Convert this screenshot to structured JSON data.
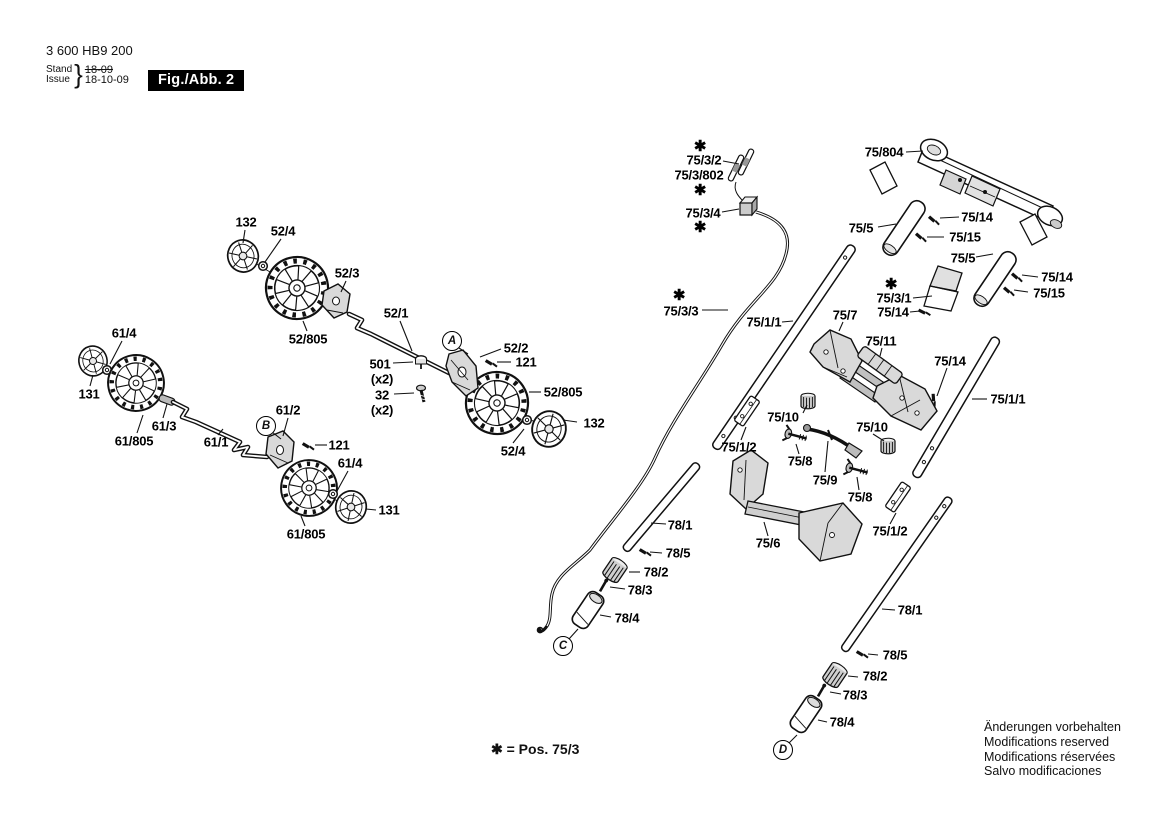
{
  "header": {
    "part_number": "3 600 HB9 200",
    "stand_label": "Stand",
    "issue_label": "Issue",
    "brace": "}",
    "stand_value": "18-09",
    "issue_value": "18-10-09",
    "figure_label": "Fig./Abb. 2"
  },
  "footnote": {
    "text": "✱ = Pos. 75/3"
  },
  "disclaimer": {
    "lines": [
      "Änderungen vorbehalten",
      "Modifications reserved",
      "Modifications réservées",
      "Salvo modificaciones"
    ]
  },
  "diagram": {
    "callouts": [
      {
        "letter": "A",
        "x": 452,
        "y": 341
      },
      {
        "letter": "B",
        "x": 266,
        "y": 426
      },
      {
        "letter": "C",
        "x": 563,
        "y": 646
      },
      {
        "letter": "D",
        "x": 783,
        "y": 750
      }
    ],
    "labels": [
      {
        "text": "132",
        "x": 246,
        "y": 222
      },
      {
        "text": "52/4",
        "x": 283,
        "y": 231
      },
      {
        "text": "52/3",
        "x": 347,
        "y": 273
      },
      {
        "text": "52/805",
        "x": 308,
        "y": 339
      },
      {
        "text": "52/1",
        "x": 396,
        "y": 313
      },
      {
        "text": "61/4",
        "x": 124,
        "y": 333
      },
      {
        "text": "131",
        "x": 89,
        "y": 394
      },
      {
        "text": "61/805",
        "x": 134,
        "y": 441
      },
      {
        "text": "61/3",
        "x": 164,
        "y": 426
      },
      {
        "text": "61/1",
        "x": 216,
        "y": 442
      },
      {
        "text": "61/2",
        "x": 288,
        "y": 410
      },
      {
        "text": "501",
        "x": 380,
        "y": 364
      },
      {
        "text": "(x2)",
        "x": 382,
        "y": 379
      },
      {
        "text": "32",
        "x": 382,
        "y": 395
      },
      {
        "text": "(x2)",
        "x": 382,
        "y": 410
      },
      {
        "text": "52/2",
        "x": 516,
        "y": 348
      },
      {
        "text": "121",
        "x": 526,
        "y": 362
      },
      {
        "text": "52/805",
        "x": 563,
        "y": 392
      },
      {
        "text": "132",
        "x": 594,
        "y": 423
      },
      {
        "text": "52/4",
        "x": 513,
        "y": 451
      },
      {
        "text": "121",
        "x": 339,
        "y": 445
      },
      {
        "text": "61/4",
        "x": 350,
        "y": 463
      },
      {
        "text": "131",
        "x": 389,
        "y": 510
      },
      {
        "text": "61/805",
        "x": 306,
        "y": 534
      },
      {
        "text": "✱",
        "x": 700,
        "y": 146,
        "star": true
      },
      {
        "text": "75/3/2",
        "x": 704,
        "y": 160
      },
      {
        "text": "75/3/802",
        "x": 699,
        "y": 175
      },
      {
        "text": "✱",
        "x": 700,
        "y": 190,
        "star": true
      },
      {
        "text": "75/3/4",
        "x": 703,
        "y": 213
      },
      {
        "text": "✱",
        "x": 700,
        "y": 227,
        "star": true
      },
      {
        "text": "75/804",
        "x": 884,
        "y": 152
      },
      {
        "text": "75/5",
        "x": 861,
        "y": 228
      },
      {
        "text": "75/14",
        "x": 977,
        "y": 217
      },
      {
        "text": "75/15",
        "x": 965,
        "y": 237
      },
      {
        "text": "75/5",
        "x": 963,
        "y": 258
      },
      {
        "text": "75/14",
        "x": 1057,
        "y": 277
      },
      {
        "text": "75/15",
        "x": 1049,
        "y": 293
      },
      {
        "text": "✱",
        "x": 891,
        "y": 284,
        "star": true
      },
      {
        "text": "75/3/1",
        "x": 894,
        "y": 298
      },
      {
        "text": "75/14",
        "x": 893,
        "y": 312
      },
      {
        "text": "✱",
        "x": 679,
        "y": 295,
        "star": true
      },
      {
        "text": "75/3/3",
        "x": 681,
        "y": 311
      },
      {
        "text": "75/1/1",
        "x": 764,
        "y": 322
      },
      {
        "text": "75/7",
        "x": 845,
        "y": 315
      },
      {
        "text": "75/11",
        "x": 881,
        "y": 341
      },
      {
        "text": "75/14",
        "x": 950,
        "y": 361
      },
      {
        "text": "75/1/1",
        "x": 1008,
        "y": 399
      },
      {
        "text": "75/10",
        "x": 783,
        "y": 417
      },
      {
        "text": "75/10",
        "x": 872,
        "y": 427
      },
      {
        "text": "75/1/2",
        "x": 739,
        "y": 447
      },
      {
        "text": "75/8",
        "x": 800,
        "y": 461
      },
      {
        "text": "75/9",
        "x": 825,
        "y": 480
      },
      {
        "text": "75/8",
        "x": 860,
        "y": 497
      },
      {
        "text": "75/6",
        "x": 768,
        "y": 543
      },
      {
        "text": "75/1/2",
        "x": 890,
        "y": 531
      },
      {
        "text": "78/1",
        "x": 680,
        "y": 525
      },
      {
        "text": "78/5",
        "x": 678,
        "y": 553
      },
      {
        "text": "78/2",
        "x": 656,
        "y": 572
      },
      {
        "text": "78/3",
        "x": 640,
        "y": 590
      },
      {
        "text": "78/4",
        "x": 627,
        "y": 618
      },
      {
        "text": "78/1",
        "x": 910,
        "y": 610
      },
      {
        "text": "78/5",
        "x": 895,
        "y": 655
      },
      {
        "text": "78/2",
        "x": 875,
        "y": 676
      },
      {
        "text": "78/3",
        "x": 855,
        "y": 695
      },
      {
        "text": "78/4",
        "x": 842,
        "y": 722
      }
    ]
  }
}
